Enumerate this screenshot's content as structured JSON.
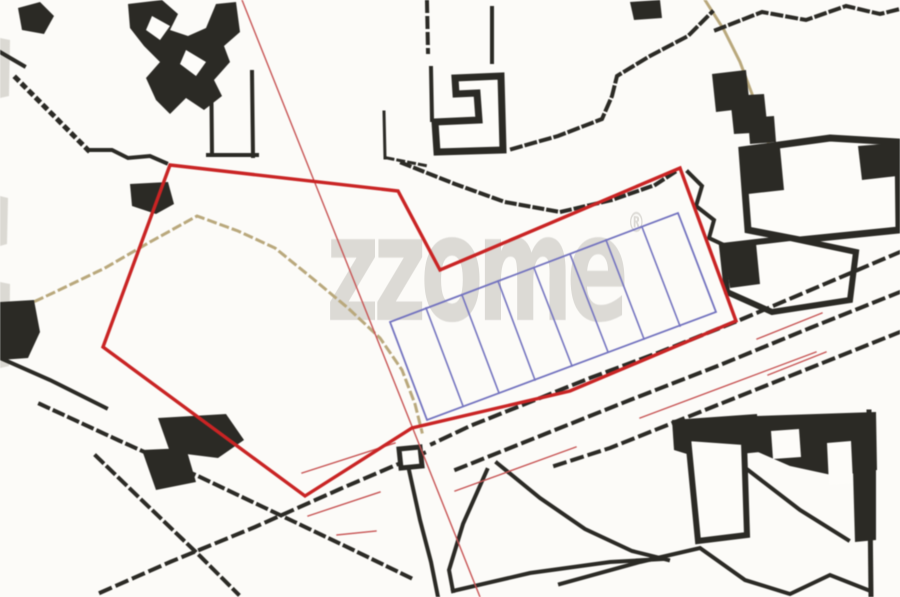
{
  "watermark": {
    "text": "zzome",
    "mark": "®"
  },
  "map": {
    "description": "cadastral-site-plan",
    "palette": {
      "bg": "#fcfbf8",
      "ink": "#2b2a25",
      "red": "#c92424",
      "thinRed": "#c75454",
      "blue": "#7373bf",
      "tan": "#b9a87c",
      "white": "#fdfcf9",
      "smudge": "#dbd9d3",
      "watermark": "#d7d5d0"
    },
    "plot_grid": {
      "plots": 8,
      "color": "blue"
    },
    "site_boundary_color": "red",
    "shapes": [
      {
        "n": "scan-smudge-1",
        "t": "polygon",
        "p": "0,38 10,40 9,96 0,98",
        "f": "smudge"
      },
      {
        "n": "scan-smudge-2",
        "t": "polygon",
        "p": "0,196 8,198 7,244 0,246",
        "f": "smudge"
      },
      {
        "n": "scan-smudge-3",
        "t": "polygon",
        "p": "0,282 10,284 9,366 0,368",
        "f": "smudge"
      },
      {
        "n": "footpath-tan",
        "t": "polyline",
        "p": "12,312 55,292 105,268 150,242 197,216 238,231 275,248 312,278 348,308 380,338 402,370 415,404 422,432",
        "s": "tan",
        "w": 3,
        "dash": "7 6"
      },
      {
        "n": "track-tan-topright",
        "t": "polyline",
        "p": "705,0 724,30 740,62 752,94 762,124 772,154 783,186 792,212",
        "s": "tan",
        "w": 3
      },
      {
        "n": "building-blob-tl-a",
        "t": "polygon",
        "p": "18,8 40,2 54,16 44,34 22,30",
        "f": "ink"
      },
      {
        "n": "boundary-line-tl",
        "t": "polyline",
        "p": "0,52 24,66",
        "s": "ink",
        "w": 4
      },
      {
        "n": "boundary-dotted-tl",
        "t": "polyline",
        "p": "16,78 40,102 64,126 88,150",
        "s": "ink",
        "w": 5,
        "dash": "2 8"
      },
      {
        "n": "boundary-jag-tl",
        "t": "polyline",
        "p": "88,150 112,150 128,158 150,156 166,163",
        "s": "ink",
        "w": 4
      },
      {
        "n": "building-cluster-tl",
        "t": "polygon",
        "p": "128,4 162,0 178,14 170,30 188,36 206,28 216,4 236,2 240,32 224,46 230,62 214,80 222,96 204,110 186,98 170,114 156,100 146,78 160,62 144,46 130,28",
        "f": "ink"
      },
      {
        "n": "building-hole-tl-1",
        "t": "polygon",
        "p": "152,16 170,26 160,40 146,30",
        "f": "white"
      },
      {
        "n": "building-hole-tl-2",
        "t": "polygon",
        "p": "186,50 206,62 196,76 180,64",
        "f": "white"
      },
      {
        "n": "wall-tl-v1",
        "t": "polyline",
        "p": "211,50 212,155",
        "s": "ink",
        "w": 4
      },
      {
        "n": "wall-tl-v2",
        "t": "polyline",
        "p": "252,72 253,156",
        "s": "ink",
        "w": 4
      },
      {
        "n": "wall-tl-h",
        "t": "polyline",
        "p": "208,155 257,155",
        "s": "ink",
        "w": 4
      },
      {
        "n": "building-blob-tl-b",
        "t": "polygon",
        "p": "130,184 168,182 174,204 156,214 132,206",
        "f": "ink"
      },
      {
        "n": "wall-v3",
        "t": "polyline",
        "p": "384,112 385,158",
        "s": "ink",
        "w": 3
      },
      {
        "n": "wall-dash-h",
        "t": "polyline",
        "p": "387,158 428,166",
        "s": "ink",
        "w": 3,
        "dash": "6 5"
      },
      {
        "n": "pole-dash-top-1",
        "t": "polyline",
        "p": "427,2 428,52",
        "s": "ink",
        "w": 4,
        "dash": "9 7"
      },
      {
        "n": "pole-top-2",
        "t": "polyline",
        "p": "492,8 492,62",
        "s": "ink",
        "w": 4
      },
      {
        "n": "building-topmid",
        "t": "path",
        "d": "M455,78 L501,76 L503,150 L437,152 L435,122 L479,120 L477,93 L456,94 Z",
        "s": "ink",
        "w": 7,
        "f": "white"
      },
      {
        "n": "building-topmid-wall",
        "t": "polyline",
        "p": "431,68 432,120",
        "s": "ink",
        "w": 4
      },
      {
        "n": "boundary-dash-ne-1",
        "t": "polyline",
        "p": "512,149 558,136 602,119 612,96 617,76 650,56 688,36 712,12",
        "s": "ink",
        "w": 4,
        "dash": "9 6"
      },
      {
        "n": "boundary-dash-top",
        "t": "polyline",
        "p": "716,30 762,12 806,20 846,6 880,14 900,9",
        "s": "ink",
        "w": 4,
        "dash": "9 6"
      },
      {
        "n": "blob-top",
        "t": "polygon",
        "p": "630,2 660,0 662,18 634,20",
        "f": "ink"
      },
      {
        "n": "building-tr-1",
        "t": "polygon",
        "p": "712,74 746,70 750,108 716,112",
        "f": "ink"
      },
      {
        "n": "building-tr-2",
        "t": "polygon",
        "p": "730,96 764,94 768,132 734,134",
        "f": "ink"
      },
      {
        "n": "building-tr-3",
        "t": "polygon",
        "p": "748,118 774,116 776,142 750,144",
        "f": "ink"
      },
      {
        "n": "building-tr-frame",
        "t": "path",
        "d": "M742,150 L830,138 L898,142 L899,230 L800,240 L748,230 Z",
        "s": "ink",
        "w": 7,
        "f": "white"
      },
      {
        "n": "building-tr-frame-fill1",
        "t": "polygon",
        "p": "744,152 780,148 784,190 748,194",
        "f": "ink"
      },
      {
        "n": "building-tr-frame-fill2",
        "t": "polygon",
        "p": "858,146 897,143 897,176 862,180",
        "f": "ink"
      },
      {
        "n": "wall-jag-right",
        "t": "polyline",
        "p": "688,172 702,186 696,206 714,220 709,238 726,246",
        "s": "ink",
        "w": 4
      },
      {
        "n": "building-midright",
        "t": "path",
        "d": "M722,246 L790,238 L856,252 L850,300 L772,312 L727,292 Z",
        "s": "ink",
        "w": 6,
        "f": "white"
      },
      {
        "n": "building-midright-fill",
        "t": "polygon",
        "p": "723,247 756,243 760,284 730,288",
        "f": "ink"
      },
      {
        "n": "boundary-dash-bd",
        "t": "polyline",
        "p": "402,163 455,184 505,202 560,212 612,200 655,185 675,172",
        "s": "ink",
        "w": 4,
        "dash": "8 6"
      },
      {
        "n": "road-edge-north",
        "t": "polyline",
        "p": "900,252 820,286 740,320 660,352 590,378 520,406 470,426 432,444",
        "s": "ink",
        "w": 4,
        "dash": "10 8"
      },
      {
        "n": "road-edge-mid",
        "t": "polyline",
        "p": "900,292 810,328 720,365 630,400 545,434 490,456 450,472",
        "s": "ink",
        "w": 4,
        "dash": "10 8"
      },
      {
        "n": "road-edge-south",
        "t": "polyline",
        "p": "900,332 800,372 700,412 610,448 548,468",
        "s": "ink",
        "w": 4,
        "dash": "10 8"
      },
      {
        "n": "road-sw-edge",
        "t": "polyline",
        "p": "424,453 340,489 255,527 170,562 95,595",
        "s": "ink",
        "w": 4,
        "dash": "10 8"
      },
      {
        "n": "track-bl-1",
        "t": "polyline",
        "p": "40,404 120,441 200,477 280,515 345,546 415,580",
        "s": "ink",
        "w": 4,
        "dash": "9 7"
      },
      {
        "n": "track-bl-2",
        "t": "polyline",
        "p": "96,456 150,508 200,556 238,594",
        "s": "ink",
        "w": 4,
        "dash": "9 7"
      },
      {
        "n": "building-bl-1",
        "t": "polygon",
        "p": "158,418 226,414 244,440 218,458 170,452",
        "f": "ink"
      },
      {
        "n": "building-bl-2",
        "t": "polygon",
        "p": "142,450 186,448 196,482 156,490",
        "f": "ink"
      },
      {
        "n": "blob-midleft",
        "t": "polygon",
        "p": "0,302 34,300 40,332 28,358 0,360",
        "f": "ink"
      },
      {
        "n": "line-midleft",
        "t": "polyline",
        "p": "0,358 50,380 106,408",
        "s": "ink",
        "w": 4
      },
      {
        "n": "junction-hut",
        "t": "path",
        "d": "M399,449 L420,447 L422,466 L401,468 Z",
        "s": "ink",
        "w": 5,
        "f": "white"
      },
      {
        "n": "road-s-edge-1",
        "t": "polyline",
        "p": "409,470 420,520 431,562 438,597",
        "s": "ink",
        "w": 4
      },
      {
        "n": "road-s-edge-2",
        "t": "polyline",
        "p": "497,463 540,498 585,529 632,551 668,560",
        "s": "ink",
        "w": 4
      },
      {
        "n": "field-edge-west",
        "t": "polyline",
        "p": "487,470 463,524 449,570 453,591",
        "s": "ink",
        "w": 4
      },
      {
        "n": "field-edge-south",
        "t": "polyline",
        "p": "453,591 530,573 610,562 663,559",
        "s": "ink",
        "w": 4
      },
      {
        "n": "building-br-row",
        "t": "polygon",
        "p": "672,420 757,414 760,452 700,458 674,450",
        "f": "ink"
      },
      {
        "n": "building-br-quad",
        "t": "path",
        "d": "M688,438 L744,442 L747,535 L698,541 Z",
        "s": "ink",
        "w": 6,
        "f": "white"
      },
      {
        "n": "building-br-mass",
        "t": "polygon",
        "p": "757,416 876,412 877,470 836,476 790,466 758,452",
        "f": "ink"
      },
      {
        "n": "building-br-hole1",
        "t": "polygon",
        "p": "771,431 799,429 801,457 773,459",
        "f": "white"
      },
      {
        "n": "building-br-hole2",
        "t": "polygon",
        "p": "827,443 851,441 853,483 829,485",
        "f": "white"
      },
      {
        "n": "wall-right-edge",
        "t": "polyline",
        "p": "869,412 871,597",
        "s": "ink",
        "w": 5
      },
      {
        "n": "building-br-mass2",
        "t": "polygon",
        "p": "853,470 876,468 876,540 855,542",
        "f": "ink"
      },
      {
        "n": "wall-br-zigzag",
        "t": "polyline",
        "p": "560,584 640,562 700,548 745,580 790,594 830,575 868,590",
        "s": "ink",
        "w": 4
      },
      {
        "n": "wall-br-diag",
        "t": "polyline",
        "p": "748,470 800,510 848,540",
        "s": "ink",
        "w": 4
      },
      {
        "n": "plot-grid-outline",
        "t": "polygon",
        "p": "390,322 678,213 716,312 427,420",
        "s": "blue",
        "w": 1.8
      },
      {
        "n": "plot-divider-1",
        "t": "polyline",
        "p": "426,308 463,406",
        "s": "blue",
        "w": 1.6
      },
      {
        "n": "plot-divider-2",
        "t": "polyline",
        "p": "462,295 499,393",
        "s": "blue",
        "w": 1.6
      },
      {
        "n": "plot-divider-3",
        "t": "polyline",
        "p": "498,281 535,380",
        "s": "blue",
        "w": 1.6
      },
      {
        "n": "plot-divider-4",
        "t": "polyline",
        "p": "534,268 572,366",
        "s": "blue",
        "w": 1.6
      },
      {
        "n": "plot-divider-5",
        "t": "polyline",
        "p": "570,254 608,352",
        "s": "blue",
        "w": 1.6
      },
      {
        "n": "plot-divider-6",
        "t": "polyline",
        "p": "606,240 644,339",
        "s": "blue",
        "w": 1.6
      },
      {
        "n": "plot-divider-7",
        "t": "polyline",
        "p": "642,227 680,326",
        "s": "blue",
        "w": 1.6
      },
      {
        "n": "survey-line-diagonal",
        "t": "polyline",
        "p": "242,0 480,597",
        "s": "thinRed",
        "w": 1.4
      },
      {
        "n": "survey-seg-a",
        "t": "polyline",
        "p": "302,473 395,443",
        "s": "thinRed",
        "w": 1.4
      },
      {
        "n": "survey-seg-b",
        "t": "polyline",
        "p": "308,516 380,492",
        "s": "thinRed",
        "w": 1.4
      },
      {
        "n": "survey-tick",
        "t": "polyline",
        "p": "337,535 376,531",
        "s": "thinRed",
        "w": 1.4
      },
      {
        "n": "survey-seg-c",
        "t": "polyline",
        "p": "455,491 576,447",
        "s": "thinRed",
        "w": 1.4
      },
      {
        "n": "survey-seg-d",
        "t": "polyline",
        "p": "640,418 816,352",
        "s": "thinRed",
        "w": 1.4
      },
      {
        "n": "survey-seg-e",
        "t": "polyline",
        "p": "757,339 822,313",
        "s": "thinRed",
        "w": 1.4
      },
      {
        "n": "survey-seg-f",
        "t": "polyline",
        "p": "768,375 826,352",
        "s": "thinRed",
        "w": 1.4
      },
      {
        "n": "site-boundary",
        "t": "polygon",
        "p": "170,165 398,191 440,270 680,168 736,321 570,391 412,428 305,496 103,347",
        "s": "red",
        "w": 3.4
      }
    ]
  }
}
